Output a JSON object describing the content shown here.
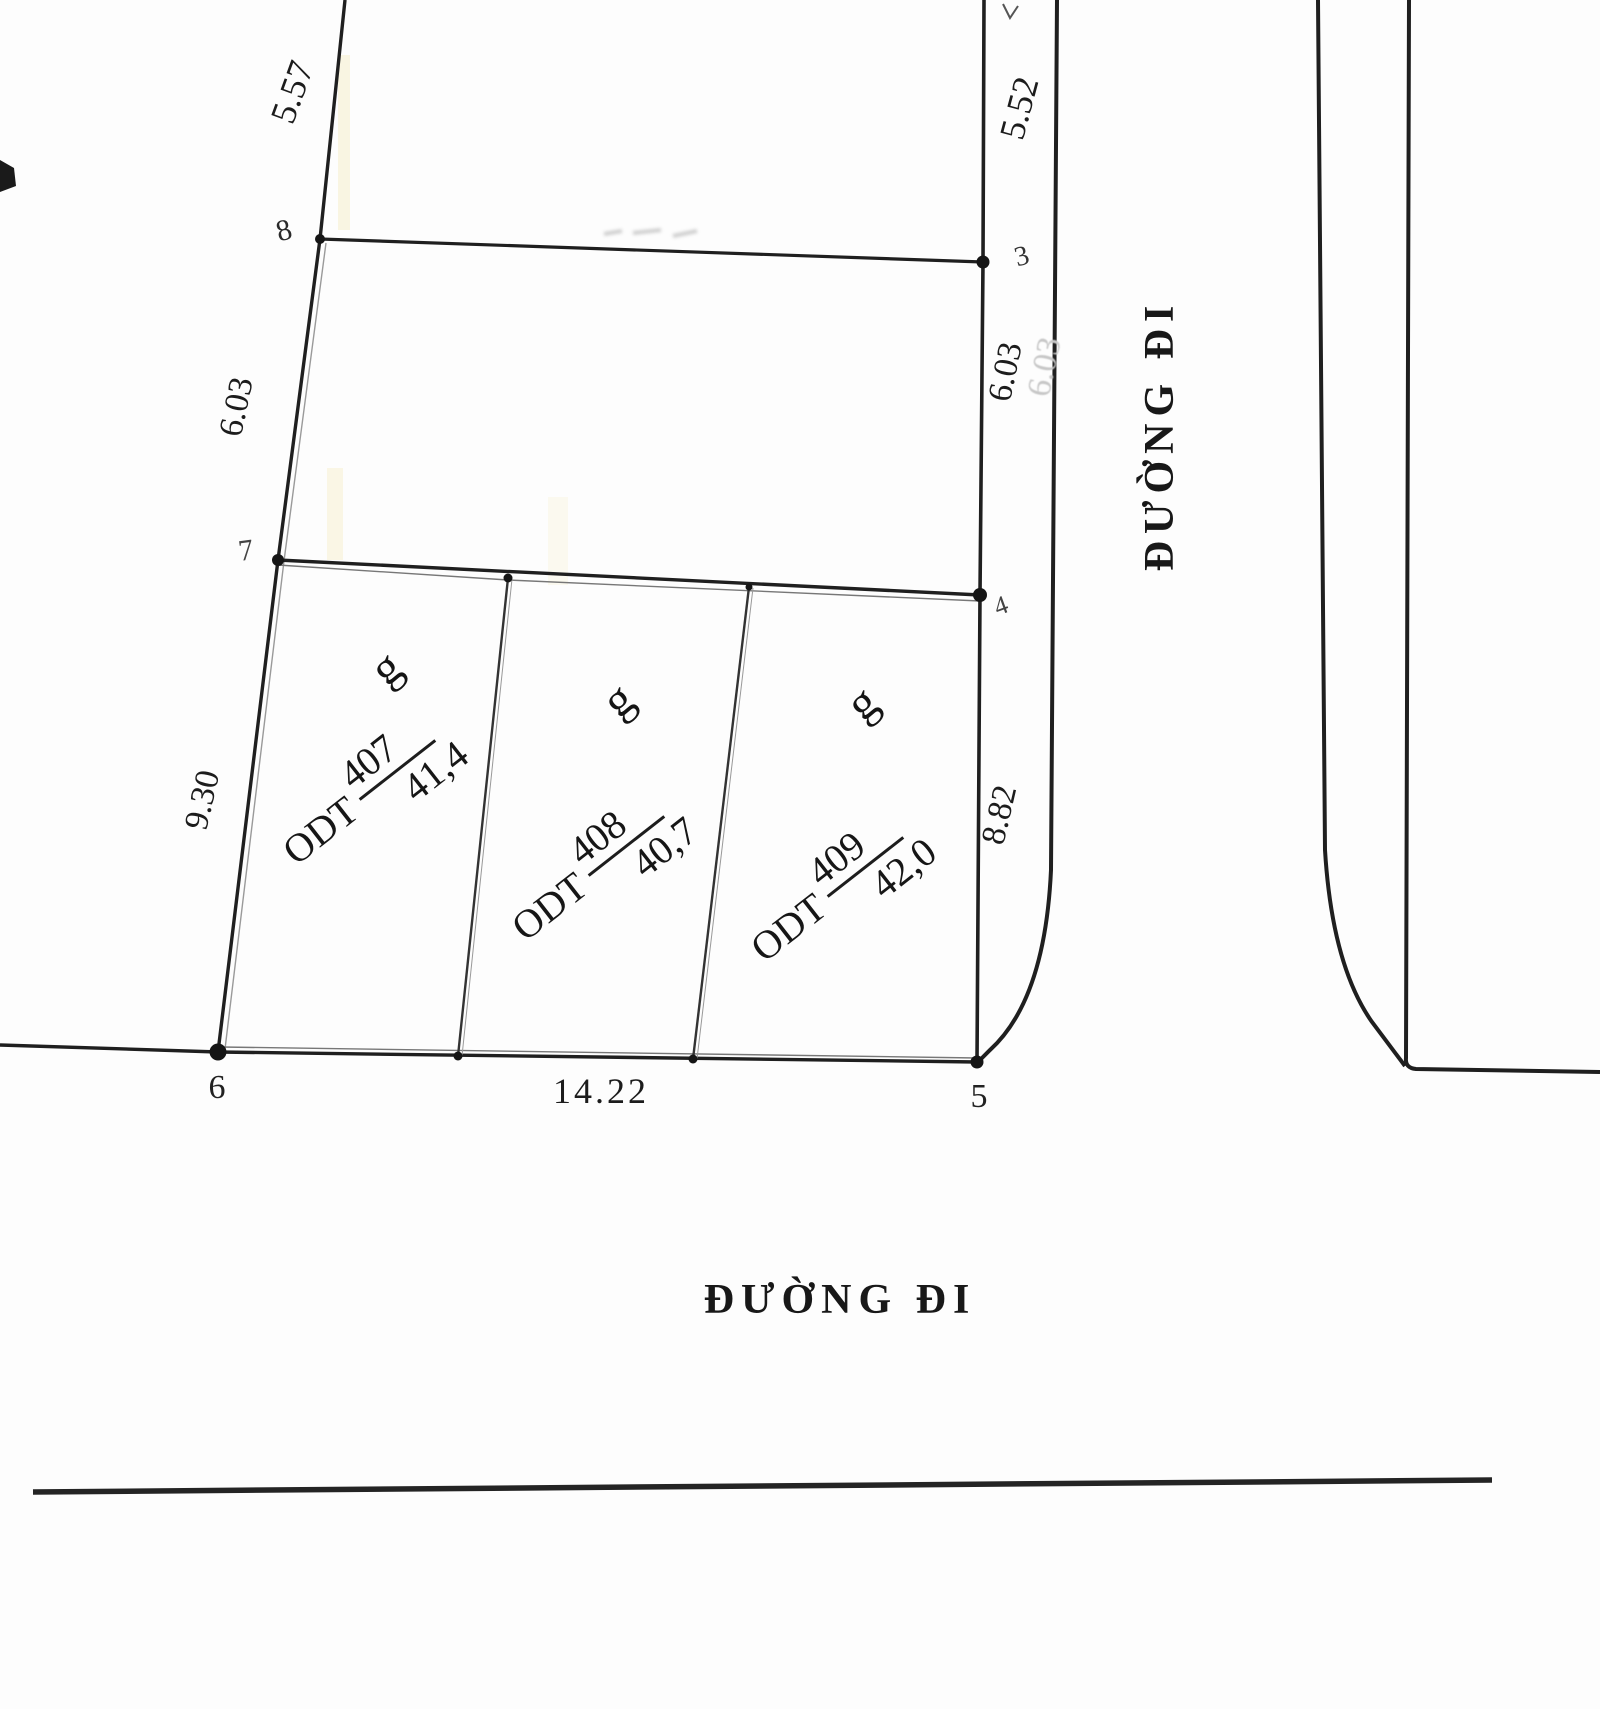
{
  "map": {
    "road_label_east": "ĐƯỜNG ĐI",
    "road_label_south": "ĐƯỜNG ĐI",
    "dimensions": {
      "d_5_57": "5.57",
      "d_5_52": "5.52",
      "d_6_03_left": "6.03",
      "d_6_03_right": "6.03",
      "d_6_03_ghost": "6.03",
      "d_9_30": "9.30",
      "d_8_82": "8.82",
      "d_14_22": "14.22"
    },
    "vertices": {
      "v3": "3",
      "v4": "4",
      "v5": "5",
      "v6": "6",
      "v7": "7",
      "v8": "8"
    },
    "parcels": [
      {
        "letter": "g",
        "code": "ODT",
        "number": "407",
        "area": "41,4"
      },
      {
        "letter": "g",
        "code": "ODT",
        "number": "408",
        "area": "40,7"
      },
      {
        "letter": "g",
        "code": "ODT",
        "number": "409",
        "area": "42,0"
      }
    ]
  }
}
